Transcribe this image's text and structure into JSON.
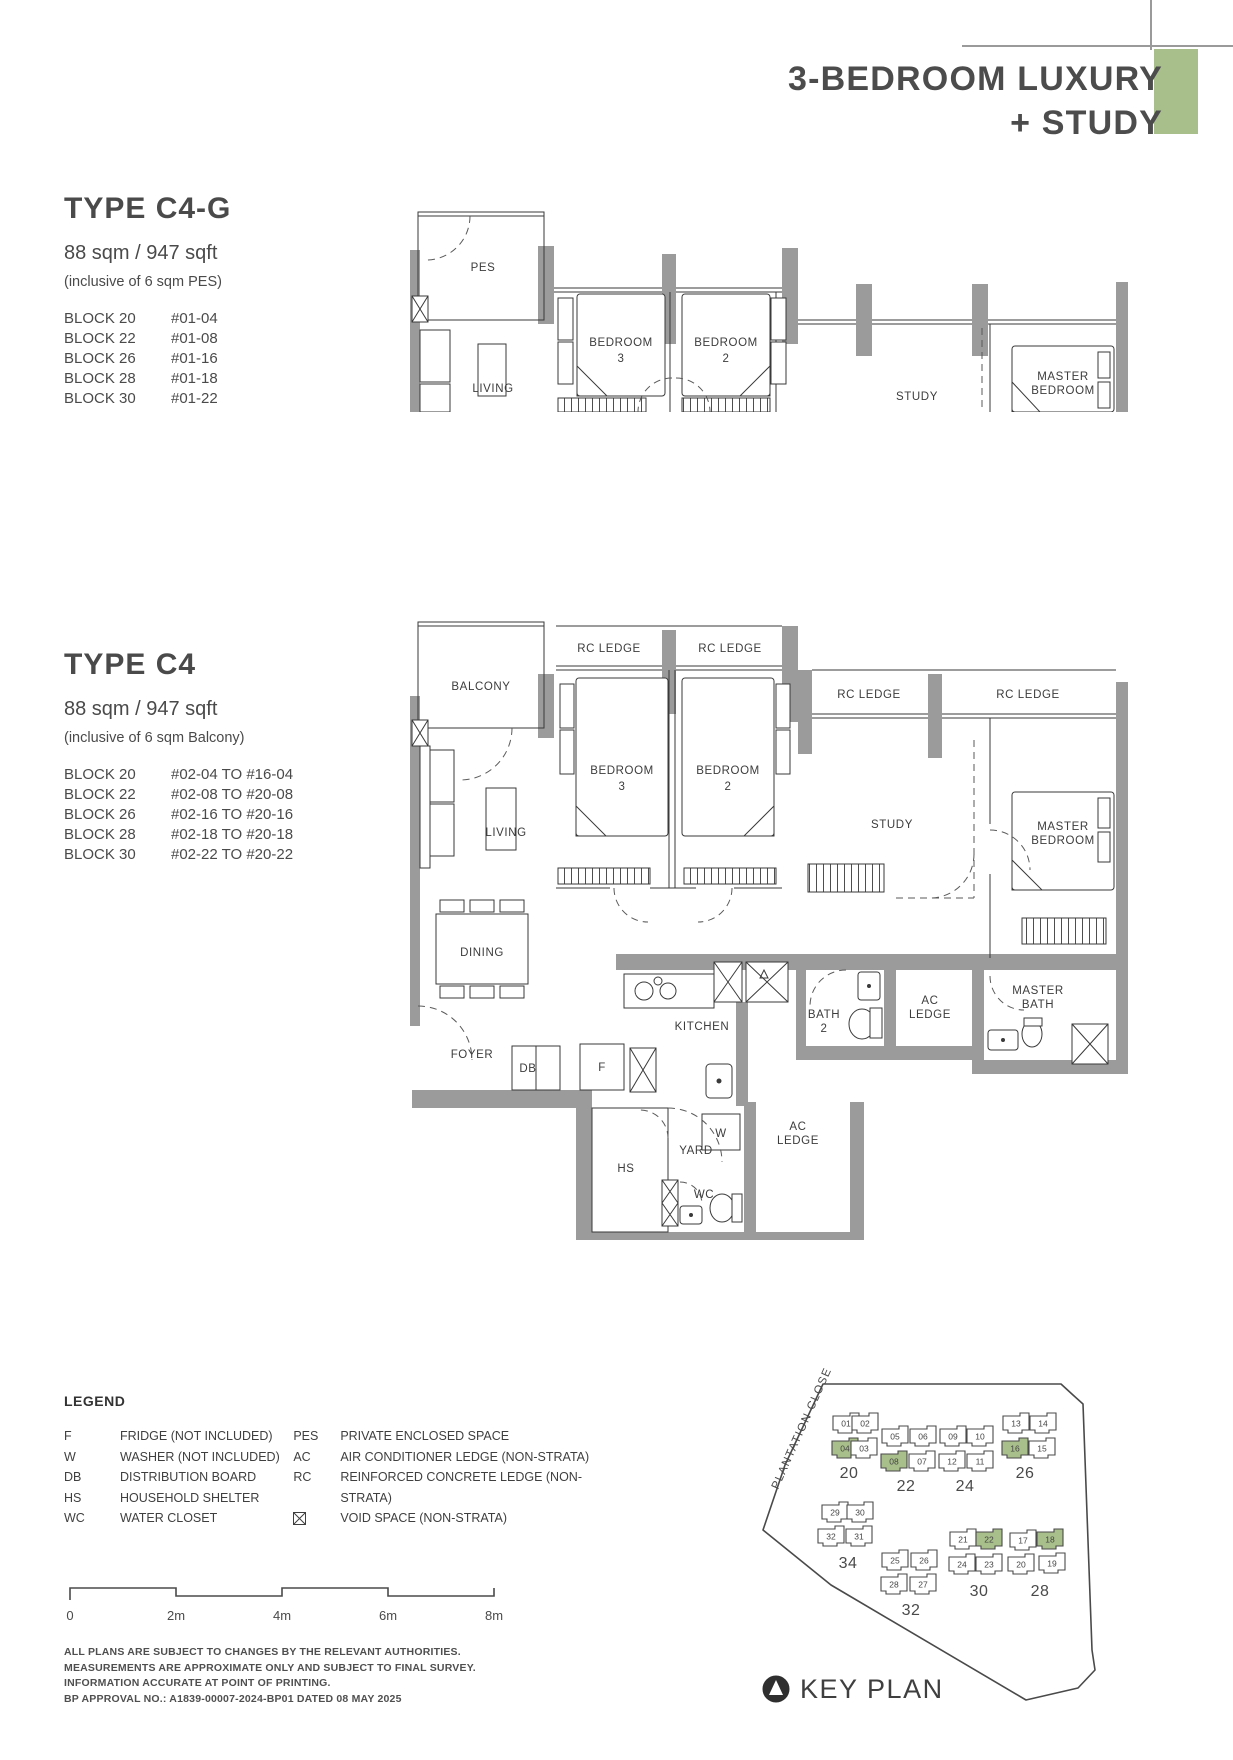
{
  "page": {
    "title_line1": "3-BEDROOM LUXURY",
    "title_line2": "+ STUDY",
    "accent_color": "#a8bf8b"
  },
  "type_c4g": {
    "name": "TYPE C4-G",
    "area": "88 sqm / 947 sqft",
    "note": "(inclusive of 6 sqm PES)",
    "blocks": [
      {
        "block": "BLOCK 20",
        "units": "#01-04"
      },
      {
        "block": "BLOCK 22",
        "units": "#01-08"
      },
      {
        "block": "BLOCK 26",
        "units": "#01-16"
      },
      {
        "block": "BLOCK 28",
        "units": "#01-18"
      },
      {
        "block": "BLOCK 30",
        "units": "#01-22"
      }
    ]
  },
  "type_c4": {
    "name": "TYPE C4",
    "area": "88 sqm / 947 sqft",
    "note": "(inclusive of 6 sqm Balcony)",
    "blocks": [
      {
        "block": "BLOCK 20",
        "units": "#02-04 TO #16-04"
      },
      {
        "block": "BLOCK 22",
        "units": "#02-08 TO #20-08"
      },
      {
        "block": "BLOCK 26",
        "units": "#02-16 TO #20-16"
      },
      {
        "block": "BLOCK 28",
        "units": "#02-18 TO #20-18"
      },
      {
        "block": "BLOCK 30",
        "units": "#02-22 TO #20-22"
      }
    ]
  },
  "plans": {
    "c4g": {
      "pes": "PES",
      "living": "LIVING",
      "bedroom3": [
        "BEDROOM",
        "3"
      ],
      "bedroom2": [
        "BEDROOM",
        "2"
      ],
      "study": "STUDY",
      "master": [
        "MASTER",
        "BEDROOM"
      ]
    },
    "c4": {
      "balcony": "BALCONY",
      "rc_ledge": "RC LEDGE",
      "living": "LIVING",
      "dining": "DINING",
      "foyer": "FOYER",
      "db": "DB",
      "fridge": "F",
      "kitchen": "KITCHEN",
      "bath2": [
        "BATH",
        "2"
      ],
      "ac_ledge": [
        "AC",
        "LEDGE"
      ],
      "master_bath": [
        "MASTER",
        "BATH"
      ],
      "hs": "HS",
      "yard": "YARD",
      "washer": "W",
      "wc": "WC",
      "bedroom3": [
        "BEDROOM",
        "3"
      ],
      "bedroom2": [
        "BEDROOM",
        "2"
      ],
      "study": "STUDY",
      "master": [
        "MASTER",
        "BEDROOM"
      ]
    }
  },
  "legend": {
    "title": "LEGEND",
    "col1": [
      {
        "key": "F",
        "desc": "FRIDGE (NOT INCLUDED)"
      },
      {
        "key": "W",
        "desc": "WASHER (NOT INCLUDED)"
      },
      {
        "key": "DB",
        "desc": "DISTRIBUTION BOARD"
      },
      {
        "key": "HS",
        "desc": "HOUSEHOLD SHELTER"
      },
      {
        "key": "WC",
        "desc": "WATER CLOSET"
      }
    ],
    "col2": [
      {
        "key": "PES",
        "desc": "PRIVATE ENCLOSED SPACE"
      },
      {
        "key": "AC",
        "desc": "AIR CONDITIONER LEDGE (NON-STRATA)"
      },
      {
        "key": "RC",
        "desc": "REINFORCED CONCRETE LEDGE (NON-STRATA)"
      },
      {
        "icon": "void-space-icon",
        "desc": "VOID SPACE (NON-STRATA)"
      }
    ]
  },
  "scalebar": {
    "ticks": [
      "0",
      "2m",
      "4m",
      "6m",
      "8m"
    ]
  },
  "disclaimer": {
    "lines": [
      "ALL PLANS ARE SUBJECT TO CHANGES BY THE RELEVANT AUTHORITIES.",
      "MEASUREMENTS ARE APPROXIMATE ONLY AND SUBJECT TO FINAL SURVEY.",
      "INFORMATION ACCURATE AT POINT OF PRINTING.",
      "BP APPROVAL NO.: A1839-00007-2024-BP01 DATED 08 MAY 2025"
    ]
  },
  "keyplan": {
    "street": "PLANTATION CLOSE",
    "label": "KEY PLAN",
    "highlight_color": "#a8bf8b",
    "clusters": [
      {
        "block": "20",
        "label_x": 171,
        "label_y": 246,
        "units": [
          {
            "n": "01",
            "x": 168,
            "y": 192
          },
          {
            "n": "02",
            "x": 187,
            "y": 192
          },
          {
            "n": "04",
            "x": 167,
            "y": 217,
            "green": true
          },
          {
            "n": "03",
            "x": 186,
            "y": 217
          }
        ]
      },
      {
        "block": "22",
        "label_x": 228,
        "label_y": 259,
        "units": [
          {
            "n": "05",
            "x": 217,
            "y": 205
          },
          {
            "n": "06",
            "x": 245,
            "y": 205
          },
          {
            "n": "08",
            "x": 216,
            "y": 230,
            "green": true
          },
          {
            "n": "07",
            "x": 244,
            "y": 230
          }
        ]
      },
      {
        "block": "24",
        "label_x": 287,
        "label_y": 259,
        "units": [
          {
            "n": "09",
            "x": 275,
            "y": 205
          },
          {
            "n": "10",
            "x": 302,
            "y": 205
          },
          {
            "n": "12",
            "x": 274,
            "y": 230
          },
          {
            "n": "11",
            "x": 302,
            "y": 230
          }
        ]
      },
      {
        "block": "26",
        "label_x": 347,
        "label_y": 246,
        "units": [
          {
            "n": "13",
            "x": 338,
            "y": 192
          },
          {
            "n": "14",
            "x": 365,
            "y": 192
          },
          {
            "n": "16",
            "x": 337,
            "y": 217,
            "green": true
          },
          {
            "n": "15",
            "x": 364,
            "y": 217
          }
        ]
      },
      {
        "block": "34",
        "label_x": 170,
        "label_y": 336,
        "units": [
          {
            "n": "29",
            "x": 157,
            "y": 281
          },
          {
            "n": "30",
            "x": 182,
            "y": 281
          },
          {
            "n": "32",
            "x": 153,
            "y": 305
          },
          {
            "n": "31",
            "x": 181,
            "y": 305
          }
        ]
      },
      {
        "block": "32",
        "label_x": 233,
        "label_y": 383,
        "units": [
          {
            "n": "25",
            "x": 217,
            "y": 329
          },
          {
            "n": "26",
            "x": 246,
            "y": 329
          },
          {
            "n": "28",
            "x": 216,
            "y": 353
          },
          {
            "n": "27",
            "x": 245,
            "y": 353
          }
        ]
      },
      {
        "block": "30",
        "label_x": 301,
        "label_y": 364,
        "units": [
          {
            "n": "21",
            "x": 285,
            "y": 308
          },
          {
            "n": "22",
            "x": 311,
            "y": 308,
            "green": true
          },
          {
            "n": "24",
            "x": 284,
            "y": 333
          },
          {
            "n": "23",
            "x": 311,
            "y": 333
          }
        ]
      },
      {
        "block": "28",
        "label_x": 362,
        "label_y": 364,
        "units": [
          {
            "n": "17",
            "x": 345,
            "y": 309
          },
          {
            "n": "18",
            "x": 372,
            "y": 308,
            "green": true
          },
          {
            "n": "20",
            "x": 343,
            "y": 333
          },
          {
            "n": "19",
            "x": 374,
            "y": 332
          }
        ]
      }
    ]
  }
}
